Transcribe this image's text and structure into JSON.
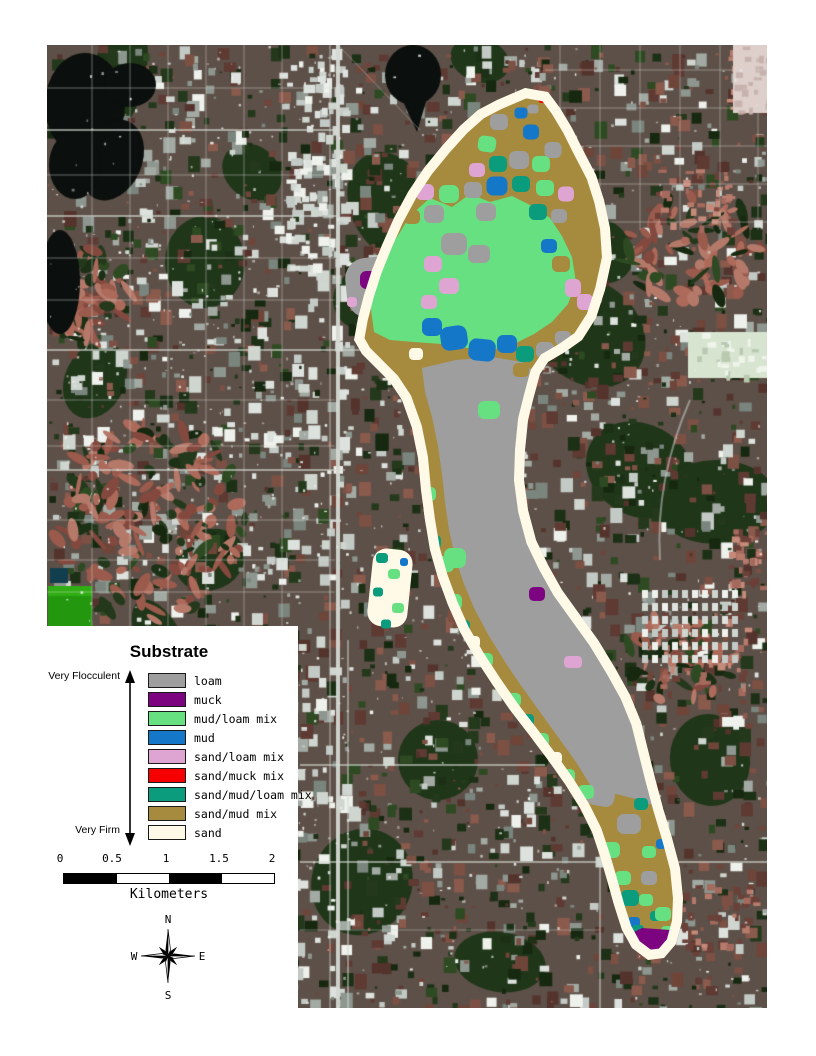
{
  "legend": {
    "title": "Substrate",
    "scale_top": "Very Flocculent",
    "scale_bottom": "Very Firm",
    "items": [
      {
        "key": "loam",
        "label": "loam",
        "color": "#9e9e9e"
      },
      {
        "key": "muck",
        "label": "muck",
        "color": "#7d0480"
      },
      {
        "key": "mud_loam",
        "label": "mud/loam mix",
        "color": "#66e080"
      },
      {
        "key": "mud",
        "label": "mud",
        "color": "#1577c8"
      },
      {
        "key": "sand_loam",
        "label": "sand/loam mix",
        "color": "#dfa5d2"
      },
      {
        "key": "sand_muck",
        "label": "sand/muck mix",
        "color": "#f60000"
      },
      {
        "key": "sand_mud_loam",
        "label": "sand/mud/loam mix",
        "color": "#0a9c7c"
      },
      {
        "key": "sand_mud",
        "label": "sand/mud mix",
        "color": "#a68a3e"
      },
      {
        "key": "sand",
        "label": "sand",
        "color": "#fffae8"
      }
    ]
  },
  "scale_bar": {
    "tick_labels": [
      "0",
      "0.5",
      "1",
      "1.5",
      "2"
    ],
    "unit_label": "Kilometers"
  },
  "compass": {
    "n": "N",
    "e": "E",
    "s": "S",
    "w": "W"
  }
}
